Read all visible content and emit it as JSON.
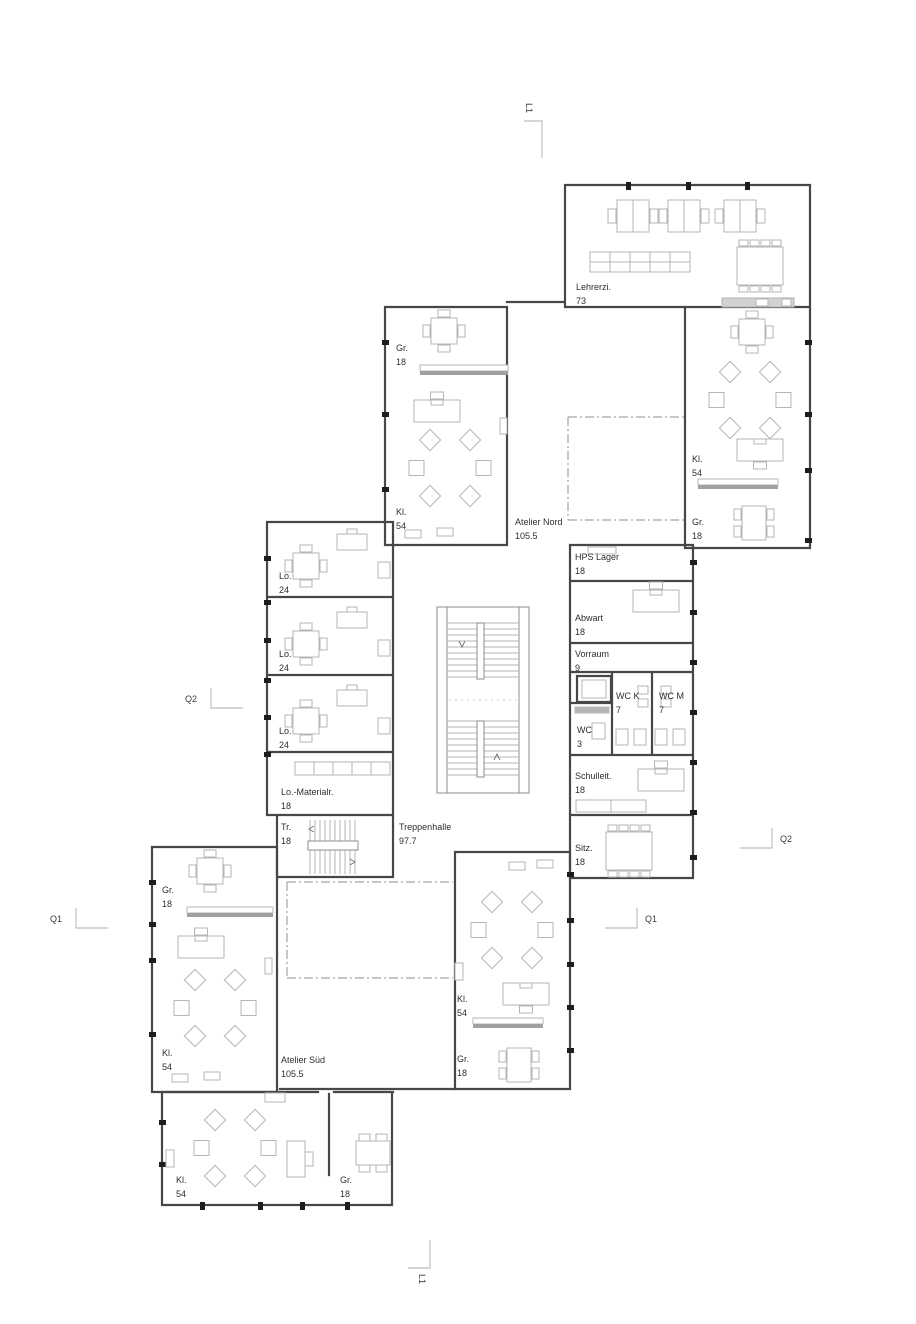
{
  "colors": {
    "wall": "#474747",
    "furniture": "#b6b6b6",
    "background": "#ffffff",
    "text": "#2e2e2e"
  },
  "rooms": [
    {
      "name": "Lehrerzi.",
      "area": "73"
    },
    {
      "name": "Gr.",
      "area": "18"
    },
    {
      "name": "Kl.",
      "area": "54"
    },
    {
      "name": "Atelier Nord",
      "area": "105.5"
    },
    {
      "name": "Kl.",
      "area": "54"
    },
    {
      "name": "Gr.",
      "area": "18"
    },
    {
      "name": "HPS Lager",
      "area": "18"
    },
    {
      "name": "Abwart",
      "area": "18"
    },
    {
      "name": "Vorraum",
      "area": "9"
    },
    {
      "name": "WC K",
      "area": "7"
    },
    {
      "name": "WC M",
      "area": "7"
    },
    {
      "name": "WC",
      "area": "3"
    },
    {
      "name": "Lo.",
      "area": "24"
    },
    {
      "name": "Lo.",
      "area": "24"
    },
    {
      "name": "Lo.",
      "area": "24"
    },
    {
      "name": "Lo.-Materialr.",
      "area": "18"
    },
    {
      "name": "Tr.",
      "area": "18"
    },
    {
      "name": "Treppenhalle",
      "area": "97.7"
    },
    {
      "name": "Schulleit.",
      "area": "18"
    },
    {
      "name": "Sitz.",
      "area": "18"
    },
    {
      "name": "Gr.",
      "area": "18"
    },
    {
      "name": "Kl.",
      "area": "54"
    },
    {
      "name": "Atelier Süd",
      "area": "105.5"
    },
    {
      "name": "Kl.",
      "area": "54"
    },
    {
      "name": "Gr.",
      "area": "18"
    },
    {
      "name": "Kl.",
      "area": "54"
    },
    {
      "name": "Gr.",
      "area": "18"
    }
  ],
  "markers": {
    "l1_top": "L1",
    "l1_bottom": "L1",
    "q1_left": "Q1",
    "q1_right": "Q1",
    "q2_left": "Q2",
    "q2_right": "Q2"
  }
}
